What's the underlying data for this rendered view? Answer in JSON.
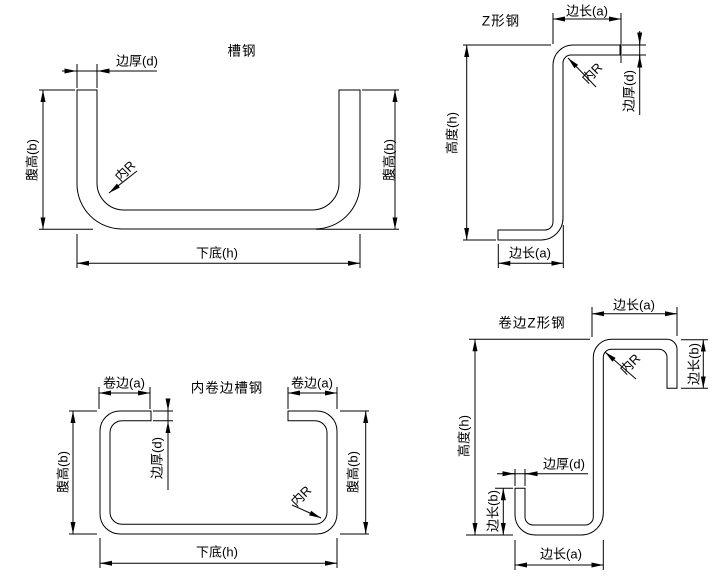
{
  "colors": {
    "line": "#000000",
    "background": "#ffffff"
  },
  "drawings": {
    "channel": {
      "title": "槽钢",
      "edge_thickness": "边厚(d)",
      "web_height_left": "腹高(b)",
      "web_height_right": "腹高(b)",
      "inner_radius": "内R",
      "bottom_width": "下底(h)"
    },
    "z_section": {
      "title": "Z形钢",
      "top_edge_length": "边长(a)",
      "inner_radius": "内R",
      "edge_thickness": "边厚(d)",
      "height": "高度(h)",
      "bottom_edge_length": "边长(a)"
    },
    "lipped_channel": {
      "title": "内卷边槽钢",
      "lip_left": "卷边(a)",
      "lip_right": "卷边(a)",
      "edge_thickness": "边厚(d)",
      "web_height_left": "腹高(b)",
      "web_height_right": "腹高(b)",
      "inner_radius": "内R",
      "bottom_width": "下底(h)"
    },
    "lipped_z_section": {
      "title": "卷边Z形钢",
      "top_edge_length": "边长(a)",
      "inner_radius": "内R",
      "right_lip_length": "边长(b)",
      "height": "高度(h)",
      "edge_thickness": "边厚(d)",
      "left_lip_length": "边长(b)",
      "bottom_edge_length": "边长(a)"
    }
  }
}
